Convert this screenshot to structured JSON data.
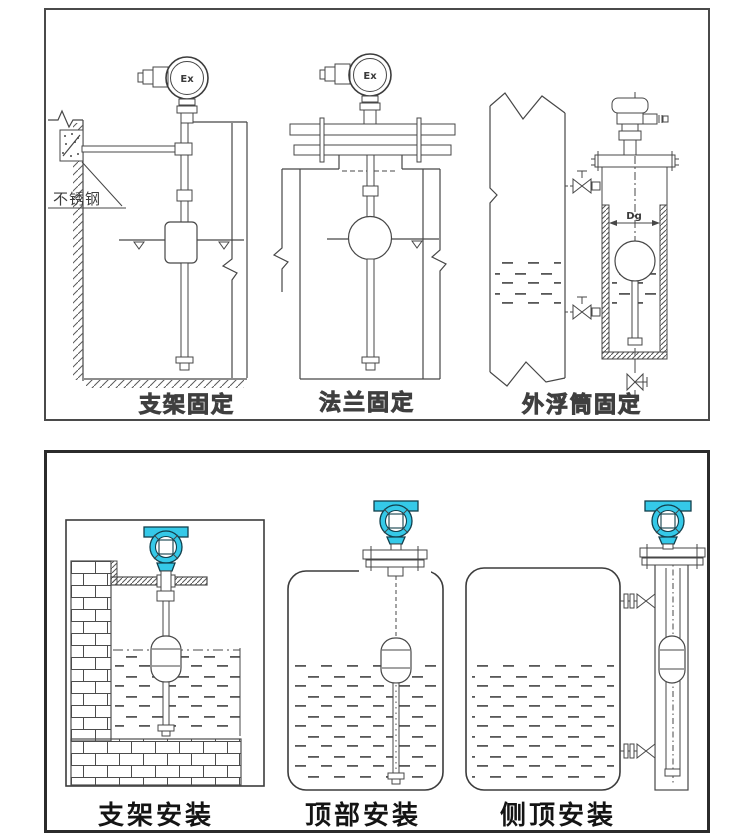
{
  "top_panel": {
    "description": "line-art mounting diagrams of float level transmitter",
    "diagrams": [
      {
        "label": "支架固定",
        "head_label": "Ex",
        "note": "不锈钢"
      },
      {
        "label": "法兰固定",
        "head_label": "Ex"
      },
      {
        "label": "外浮筒固定",
        "dim_label": "Dg"
      }
    ]
  },
  "bottom_panel": {
    "description": "installation diagrams with teal transmitter heads",
    "diagrams": [
      {
        "label": "支架安装"
      },
      {
        "label": "顶部安装"
      },
      {
        "label": "侧顶安装"
      }
    ]
  },
  "colors": {
    "line_art": "#474747",
    "label_outline": "#3f3f3f",
    "label_solid": "#141414",
    "transmitter_teal": "#35c9e8",
    "background": "#ffffff"
  }
}
